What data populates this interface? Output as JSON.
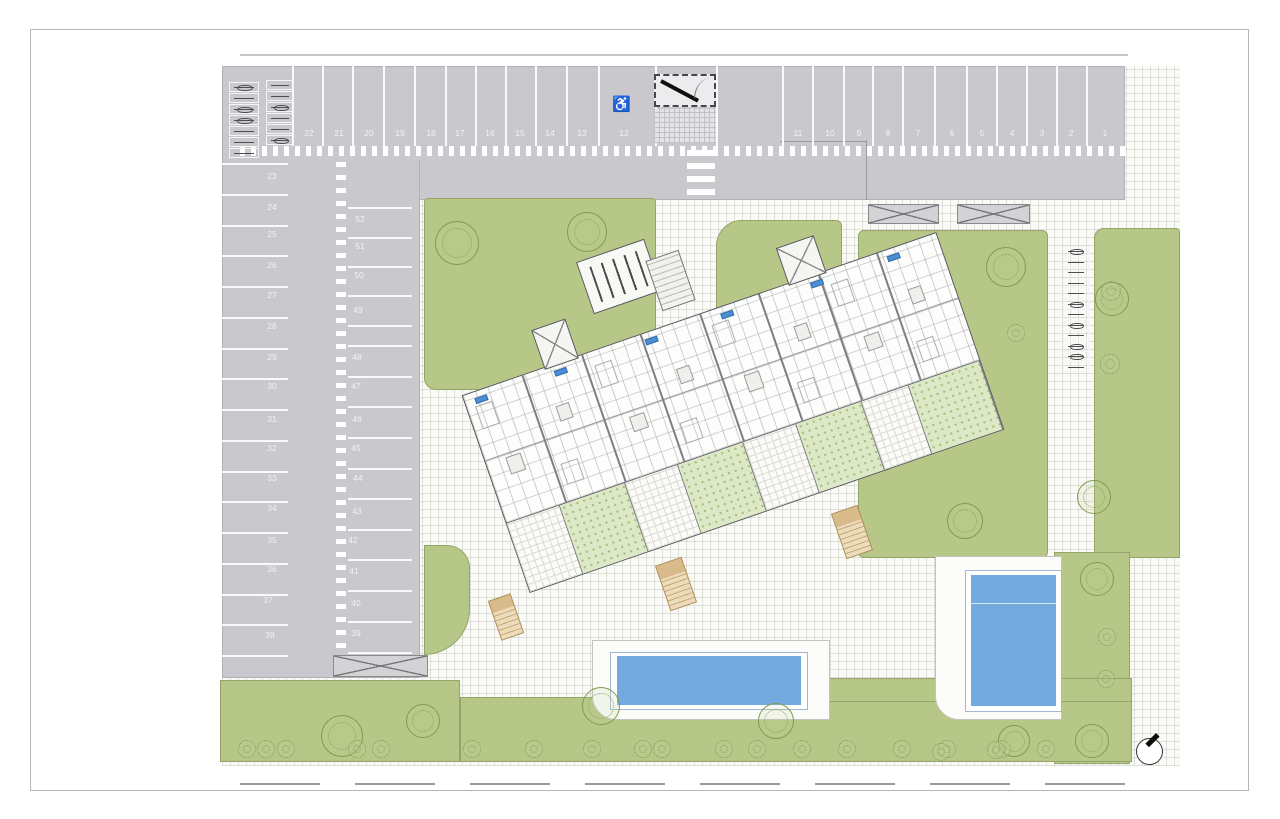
{
  "drawing": {
    "kind": "residential-site-plan",
    "accessible_space_symbol": "♿"
  },
  "colors": {
    "asphalt": "#c9c8cd",
    "lawn": "#b7c787",
    "terrace_lawn": "#dde9c6",
    "pool_water": "#72a9de",
    "path": "#fafaf7",
    "unit_tag": "#4b8fd4"
  },
  "parking": {
    "top_row_labels": [
      {
        "label": "22",
        "x": 300,
        "y": 128
      },
      {
        "label": "21",
        "x": 330,
        "y": 128
      },
      {
        "label": "20",
        "x": 360,
        "y": 128
      },
      {
        "label": "19",
        "x": 391,
        "y": 128
      },
      {
        "label": "18",
        "x": 422,
        "y": 128
      },
      {
        "label": "17",
        "x": 451,
        "y": 128
      },
      {
        "label": "16",
        "x": 481,
        "y": 128
      },
      {
        "label": "15",
        "x": 511,
        "y": 128
      },
      {
        "label": "14",
        "x": 541,
        "y": 128
      },
      {
        "label": "13",
        "x": 573,
        "y": 128
      },
      {
        "label": "12",
        "x": 615,
        "y": 128
      },
      {
        "label": "11",
        "x": 789,
        "y": 128
      },
      {
        "label": "10",
        "x": 821,
        "y": 128
      },
      {
        "label": "9",
        "x": 850,
        "y": 128
      },
      {
        "label": "8",
        "x": 879,
        "y": 128
      },
      {
        "label": "7",
        "x": 909,
        "y": 128
      },
      {
        "label": "6",
        "x": 943,
        "y": 128
      },
      {
        "label": "5",
        "x": 973,
        "y": 128
      },
      {
        "label": "4",
        "x": 1003,
        "y": 128
      },
      {
        "label": "3",
        "x": 1033,
        "y": 128
      },
      {
        "label": "2",
        "x": 1062,
        "y": 128
      },
      {
        "label": "1",
        "x": 1096,
        "y": 128
      }
    ],
    "left_column_labels": [
      {
        "label": "23",
        "x": 263,
        "y": 171
      },
      {
        "label": "24",
        "x": 263,
        "y": 202
      },
      {
        "label": "25",
        "x": 263,
        "y": 229
      },
      {
        "label": "26",
        "x": 263,
        "y": 260
      },
      {
        "label": "27",
        "x": 263,
        "y": 290
      },
      {
        "label": "28",
        "x": 263,
        "y": 321
      },
      {
        "label": "29",
        "x": 263,
        "y": 352
      },
      {
        "label": "30",
        "x": 263,
        "y": 381
      },
      {
        "label": "31",
        "x": 263,
        "y": 414
      },
      {
        "label": "32",
        "x": 263,
        "y": 443
      },
      {
        "label": "33",
        "x": 263,
        "y": 473
      },
      {
        "label": "34",
        "x": 263,
        "y": 503
      },
      {
        "label": "35",
        "x": 263,
        "y": 535
      },
      {
        "label": "36",
        "x": 263,
        "y": 564
      },
      {
        "label": "37",
        "x": 259,
        "y": 595
      },
      {
        "label": "38",
        "x": 261,
        "y": 630
      }
    ],
    "inner_column_labels": [
      {
        "label": "52",
        "x": 351,
        "y": 214
      },
      {
        "label": "51",
        "x": 351,
        "y": 241
      },
      {
        "label": "50",
        "x": 350,
        "y": 270
      },
      {
        "label": "49",
        "x": 349,
        "y": 305
      },
      {
        "label": "48",
        "x": 348,
        "y": 352
      },
      {
        "label": "47",
        "x": 347,
        "y": 381
      },
      {
        "label": "46",
        "x": 348,
        "y": 414
      },
      {
        "label": "45",
        "x": 347,
        "y": 443
      },
      {
        "label": "44",
        "x": 349,
        "y": 473
      },
      {
        "label": "43",
        "x": 348,
        "y": 506
      },
      {
        "label": "42",
        "x": 344,
        "y": 535
      },
      {
        "label": "41",
        "x": 345,
        "y": 566
      },
      {
        "label": "40",
        "x": 347,
        "y": 598
      },
      {
        "label": "39",
        "x": 347,
        "y": 628
      }
    ],
    "top_dividers": [
      {
        "x": 292,
        "y": 66,
        "h": 80
      },
      {
        "x": 322,
        "y": 66,
        "h": 80
      },
      {
        "x": 352,
        "y": 66,
        "h": 80
      },
      {
        "x": 383,
        "y": 66,
        "h": 80
      },
      {
        "x": 414,
        "y": 66,
        "h": 80
      },
      {
        "x": 445,
        "y": 66,
        "h": 80
      },
      {
        "x": 475,
        "y": 66,
        "h": 80
      },
      {
        "x": 505,
        "y": 66,
        "h": 80
      },
      {
        "x": 535,
        "y": 66,
        "h": 80
      },
      {
        "x": 566,
        "y": 66,
        "h": 80
      },
      {
        "x": 598,
        "y": 66,
        "h": 80
      },
      {
        "x": 655,
        "y": 66,
        "h": 80
      },
      {
        "x": 716,
        "y": 66,
        "h": 80
      },
      {
        "x": 782,
        "y": 66,
        "h": 80
      },
      {
        "x": 812,
        "y": 66,
        "h": 80
      },
      {
        "x": 843,
        "y": 66,
        "h": 80
      },
      {
        "x": 872,
        "y": 66,
        "h": 80
      },
      {
        "x": 902,
        "y": 66,
        "h": 80
      },
      {
        "x": 934,
        "y": 66,
        "h": 80
      },
      {
        "x": 966,
        "y": 66,
        "h": 80
      },
      {
        "x": 996,
        "y": 66,
        "h": 80
      },
      {
        "x": 1026,
        "y": 66,
        "h": 80
      },
      {
        "x": 1056,
        "y": 66,
        "h": 80
      },
      {
        "x": 1086,
        "y": 66,
        "h": 80
      }
    ],
    "left_dividers": [
      {
        "x": 222,
        "y": 163,
        "w": 66
      },
      {
        "x": 222,
        "y": 194,
        "w": 66
      },
      {
        "x": 222,
        "y": 225,
        "w": 66
      },
      {
        "x": 222,
        "y": 255,
        "w": 66
      },
      {
        "x": 222,
        "y": 286,
        "w": 66
      },
      {
        "x": 222,
        "y": 317,
        "w": 66
      },
      {
        "x": 222,
        "y": 348,
        "w": 66
      },
      {
        "x": 222,
        "y": 378,
        "w": 66
      },
      {
        "x": 222,
        "y": 409,
        "w": 66
      },
      {
        "x": 222,
        "y": 440,
        "w": 66
      },
      {
        "x": 222,
        "y": 471,
        "w": 66
      },
      {
        "x": 222,
        "y": 501,
        "w": 66
      },
      {
        "x": 222,
        "y": 532,
        "w": 66
      },
      {
        "x": 222,
        "y": 563,
        "w": 66
      },
      {
        "x": 222,
        "y": 594,
        "w": 66
      },
      {
        "x": 222,
        "y": 624,
        "w": 66
      },
      {
        "x": 222,
        "y": 655,
        "w": 66
      }
    ],
    "inner_dividers": [
      {
        "x": 348,
        "y": 207,
        "w": 64
      },
      {
        "x": 348,
        "y": 237,
        "w": 64
      },
      {
        "x": 348,
        "y": 266,
        "w": 64
      },
      {
        "x": 348,
        "y": 295,
        "w": 64
      },
      {
        "x": 348,
        "y": 325,
        "w": 64
      },
      {
        "x": 348,
        "y": 345,
        "w": 64
      },
      {
        "x": 348,
        "y": 376,
        "w": 64
      },
      {
        "x": 348,
        "y": 406,
        "w": 64
      },
      {
        "x": 348,
        "y": 437,
        "w": 64
      },
      {
        "x": 348,
        "y": 468,
        "w": 64
      },
      {
        "x": 348,
        "y": 498,
        "w": 64
      },
      {
        "x": 348,
        "y": 529,
        "w": 64
      },
      {
        "x": 348,
        "y": 559,
        "w": 64
      },
      {
        "x": 348,
        "y": 590,
        "w": 64
      },
      {
        "x": 348,
        "y": 621,
        "w": 64
      },
      {
        "x": 348,
        "y": 652,
        "w": 64
      }
    ],
    "bike_racks_topleft_a": [
      {
        "x": 229,
        "y": 82,
        "w": 30,
        "h": 10,
        "cls": "bike"
      },
      {
        "x": 229,
        "y": 93,
        "w": 30,
        "h": 10
      },
      {
        "x": 229,
        "y": 104,
        "w": 30,
        "h": 10,
        "cls": "bike"
      },
      {
        "x": 229,
        "y": 115,
        "w": 30,
        "h": 10,
        "cls": "bike"
      },
      {
        "x": 229,
        "y": 126,
        "w": 30,
        "h": 10
      },
      {
        "x": 229,
        "y": 137,
        "w": 30,
        "h": 10
      },
      {
        "x": 229,
        "y": 148,
        "w": 30,
        "h": 10
      }
    ],
    "bike_racks_topleft_b": [
      {
        "x": 266,
        "y": 80,
        "w": 28,
        "h": 10
      },
      {
        "x": 266,
        "y": 91,
        "w": 28,
        "h": 10
      },
      {
        "x": 266,
        "y": 102,
        "w": 28,
        "h": 10,
        "cls": "bike"
      },
      {
        "x": 266,
        "y": 113,
        "w": 28,
        "h": 10
      },
      {
        "x": 266,
        "y": 124,
        "w": 28,
        "h": 10
      },
      {
        "x": 266,
        "y": 135,
        "w": 28,
        "h": 10,
        "cls": "bike"
      }
    ],
    "bike_racks_right": [
      {
        "x": 1063,
        "y": 246,
        "w": 26,
        "h": 10,
        "cls": "bike"
      },
      {
        "x": 1063,
        "y": 257,
        "w": 26,
        "h": 10
      },
      {
        "x": 1063,
        "y": 267,
        "w": 26,
        "h": 10
      },
      {
        "x": 1063,
        "y": 278,
        "w": 26,
        "h": 10
      },
      {
        "x": 1063,
        "y": 288,
        "w": 26,
        "h": 10
      },
      {
        "x": 1063,
        "y": 299,
        "w": 26,
        "h": 10,
        "cls": "bike"
      },
      {
        "x": 1063,
        "y": 309,
        "w": 26,
        "h": 10
      },
      {
        "x": 1063,
        "y": 320,
        "w": 26,
        "h": 10,
        "cls": "bike"
      },
      {
        "x": 1063,
        "y": 330,
        "w": 26,
        "h": 10
      },
      {
        "x": 1063,
        "y": 341,
        "w": 26,
        "h": 10,
        "cls": "bike"
      },
      {
        "x": 1063,
        "y": 351,
        "w": 26,
        "h": 10,
        "cls": "bike"
      },
      {
        "x": 1063,
        "y": 362,
        "w": 26,
        "h": 10
      }
    ],
    "pergolas": [
      {
        "x": 868,
        "y": 204,
        "w": 71,
        "h": 20
      },
      {
        "x": 957,
        "y": 204,
        "w": 73,
        "h": 20
      }
    ],
    "ramp": {
      "x": 333,
      "y": 655,
      "w": 95,
      "h": 22
    }
  },
  "building": {
    "unit_dividers": [
      {
        "x": 62
      },
      {
        "x": 125
      },
      {
        "x": 187
      },
      {
        "x": 250
      },
      {
        "x": 312
      },
      {
        "x": 375
      },
      {
        "x": 437
      }
    ],
    "unit_tags": [
      {
        "x": 10,
        "y": 6
      },
      {
        "x": 94,
        "y": 6
      },
      {
        "x": 190,
        "y": 6
      },
      {
        "x": 270,
        "y": 6
      },
      {
        "x": 365,
        "y": 6
      },
      {
        "x": 446,
        "y": 6
      }
    ],
    "room_boxes": [
      {
        "x": 20,
        "y": 72,
        "w": 16,
        "h": 18
      },
      {
        "x": 84,
        "y": 40,
        "w": 14,
        "h": 16
      },
      {
        "x": 150,
        "y": 74,
        "w": 16,
        "h": 16
      },
      {
        "x": 210,
        "y": 44,
        "w": 14,
        "h": 16
      },
      {
        "x": 272,
        "y": 72,
        "w": 16,
        "h": 18
      },
      {
        "x": 335,
        "y": 42,
        "w": 14,
        "h": 16
      },
      {
        "x": 398,
        "y": 74,
        "w": 16,
        "h": 16
      },
      {
        "x": 455,
        "y": 44,
        "w": 14,
        "h": 16
      },
      {
        "x": 8,
        "y": 14,
        "w": 18,
        "h": 24,
        "cls": "furn"
      },
      {
        "x": 70,
        "y": 96,
        "w": 18,
        "h": 22,
        "cls": "furn"
      },
      {
        "x": 134,
        "y": 14,
        "w": 18,
        "h": 24,
        "cls": "furn"
      },
      {
        "x": 196,
        "y": 96,
        "w": 18,
        "h": 22,
        "cls": "furn"
      },
      {
        "x": 258,
        "y": 14,
        "w": 18,
        "h": 24,
        "cls": "furn"
      },
      {
        "x": 320,
        "y": 96,
        "w": 18,
        "h": 22,
        "cls": "furn"
      },
      {
        "x": 384,
        "y": 14,
        "w": 18,
        "h": 24,
        "cls": "furn"
      },
      {
        "x": 446,
        "y": 96,
        "w": 18,
        "h": 22,
        "cls": "furn"
      }
    ],
    "terrace_cells": [
      {
        "x": 0,
        "w": 56,
        "cls": "paved"
      },
      {
        "x": 56,
        "w": 69,
        "cls": "lawn"
      },
      {
        "x": 125,
        "w": 56,
        "cls": "paved"
      },
      {
        "x": 181,
        "w": 69,
        "cls": "lawn"
      },
      {
        "x": 250,
        "w": 56,
        "cls": "paved"
      },
      {
        "x": 306,
        "w": 69,
        "cls": "lawn"
      },
      {
        "x": 375,
        "w": 50,
        "cls": "paved"
      },
      {
        "x": 425,
        "w": 75,
        "cls": "lawn"
      }
    ],
    "roof_towers": [
      {
        "x": 86,
        "y": -40,
        "w": 36,
        "h": 42
      },
      {
        "x": 344,
        "y": -38,
        "w": 40,
        "h": 40
      }
    ],
    "exterior_stairs": [
      {
        "x": 494,
        "y": 596,
        "w": 24,
        "h": 42
      },
      {
        "x": 662,
        "y": 560,
        "w": 28,
        "h": 48
      },
      {
        "x": 838,
        "y": 508,
        "w": 28,
        "h": 48
      }
    ]
  },
  "landscape": {
    "trees": [
      {
        "x": 457,
        "y": 243,
        "r": 22
      },
      {
        "x": 587,
        "y": 232,
        "r": 20
      },
      {
        "x": 1006,
        "y": 267,
        "r": 20
      },
      {
        "x": 1112,
        "y": 299,
        "r": 17
      },
      {
        "x": 965,
        "y": 521,
        "r": 18
      },
      {
        "x": 1094,
        "y": 497,
        "r": 17
      },
      {
        "x": 342,
        "y": 736,
        "r": 21
      },
      {
        "x": 423,
        "y": 721,
        "r": 17
      },
      {
        "x": 601,
        "y": 706,
        "r": 19
      },
      {
        "x": 776,
        "y": 721,
        "r": 18
      },
      {
        "x": 1014,
        "y": 741,
        "r": 16
      },
      {
        "x": 1097,
        "y": 579,
        "r": 17
      },
      {
        "x": 1092,
        "y": 741,
        "r": 17
      }
    ],
    "bushes": [
      {
        "x": 247,
        "y": 749,
        "r": 9
      },
      {
        "x": 266,
        "y": 749,
        "r": 9
      },
      {
        "x": 286,
        "y": 749,
        "r": 9
      },
      {
        "x": 357,
        "y": 749,
        "r": 9
      },
      {
        "x": 381,
        "y": 749,
        "r": 9
      },
      {
        "x": 472,
        "y": 749,
        "r": 9
      },
      {
        "x": 534,
        "y": 749,
        "r": 9
      },
      {
        "x": 592,
        "y": 749,
        "r": 9
      },
      {
        "x": 643,
        "y": 749,
        "r": 9
      },
      {
        "x": 662,
        "y": 749,
        "r": 9
      },
      {
        "x": 724,
        "y": 749,
        "r": 9
      },
      {
        "x": 757,
        "y": 749,
        "r": 9
      },
      {
        "x": 802,
        "y": 749,
        "r": 9
      },
      {
        "x": 847,
        "y": 749,
        "r": 9
      },
      {
        "x": 902,
        "y": 749,
        "r": 9
      },
      {
        "x": 947,
        "y": 749,
        "r": 9
      },
      {
        "x": 1002,
        "y": 749,
        "r": 9
      },
      {
        "x": 1046,
        "y": 749,
        "r": 9
      },
      {
        "x": 1111,
        "y": 291,
        "r": 10
      },
      {
        "x": 1110,
        "y": 364,
        "r": 10
      },
      {
        "x": 1016,
        "y": 333,
        "r": 9
      },
      {
        "x": 1107,
        "y": 637,
        "r": 9
      },
      {
        "x": 1106,
        "y": 679,
        "r": 9
      },
      {
        "x": 941,
        "y": 752,
        "r": 9
      },
      {
        "x": 996,
        "y": 750,
        "r": 9
      }
    ]
  }
}
